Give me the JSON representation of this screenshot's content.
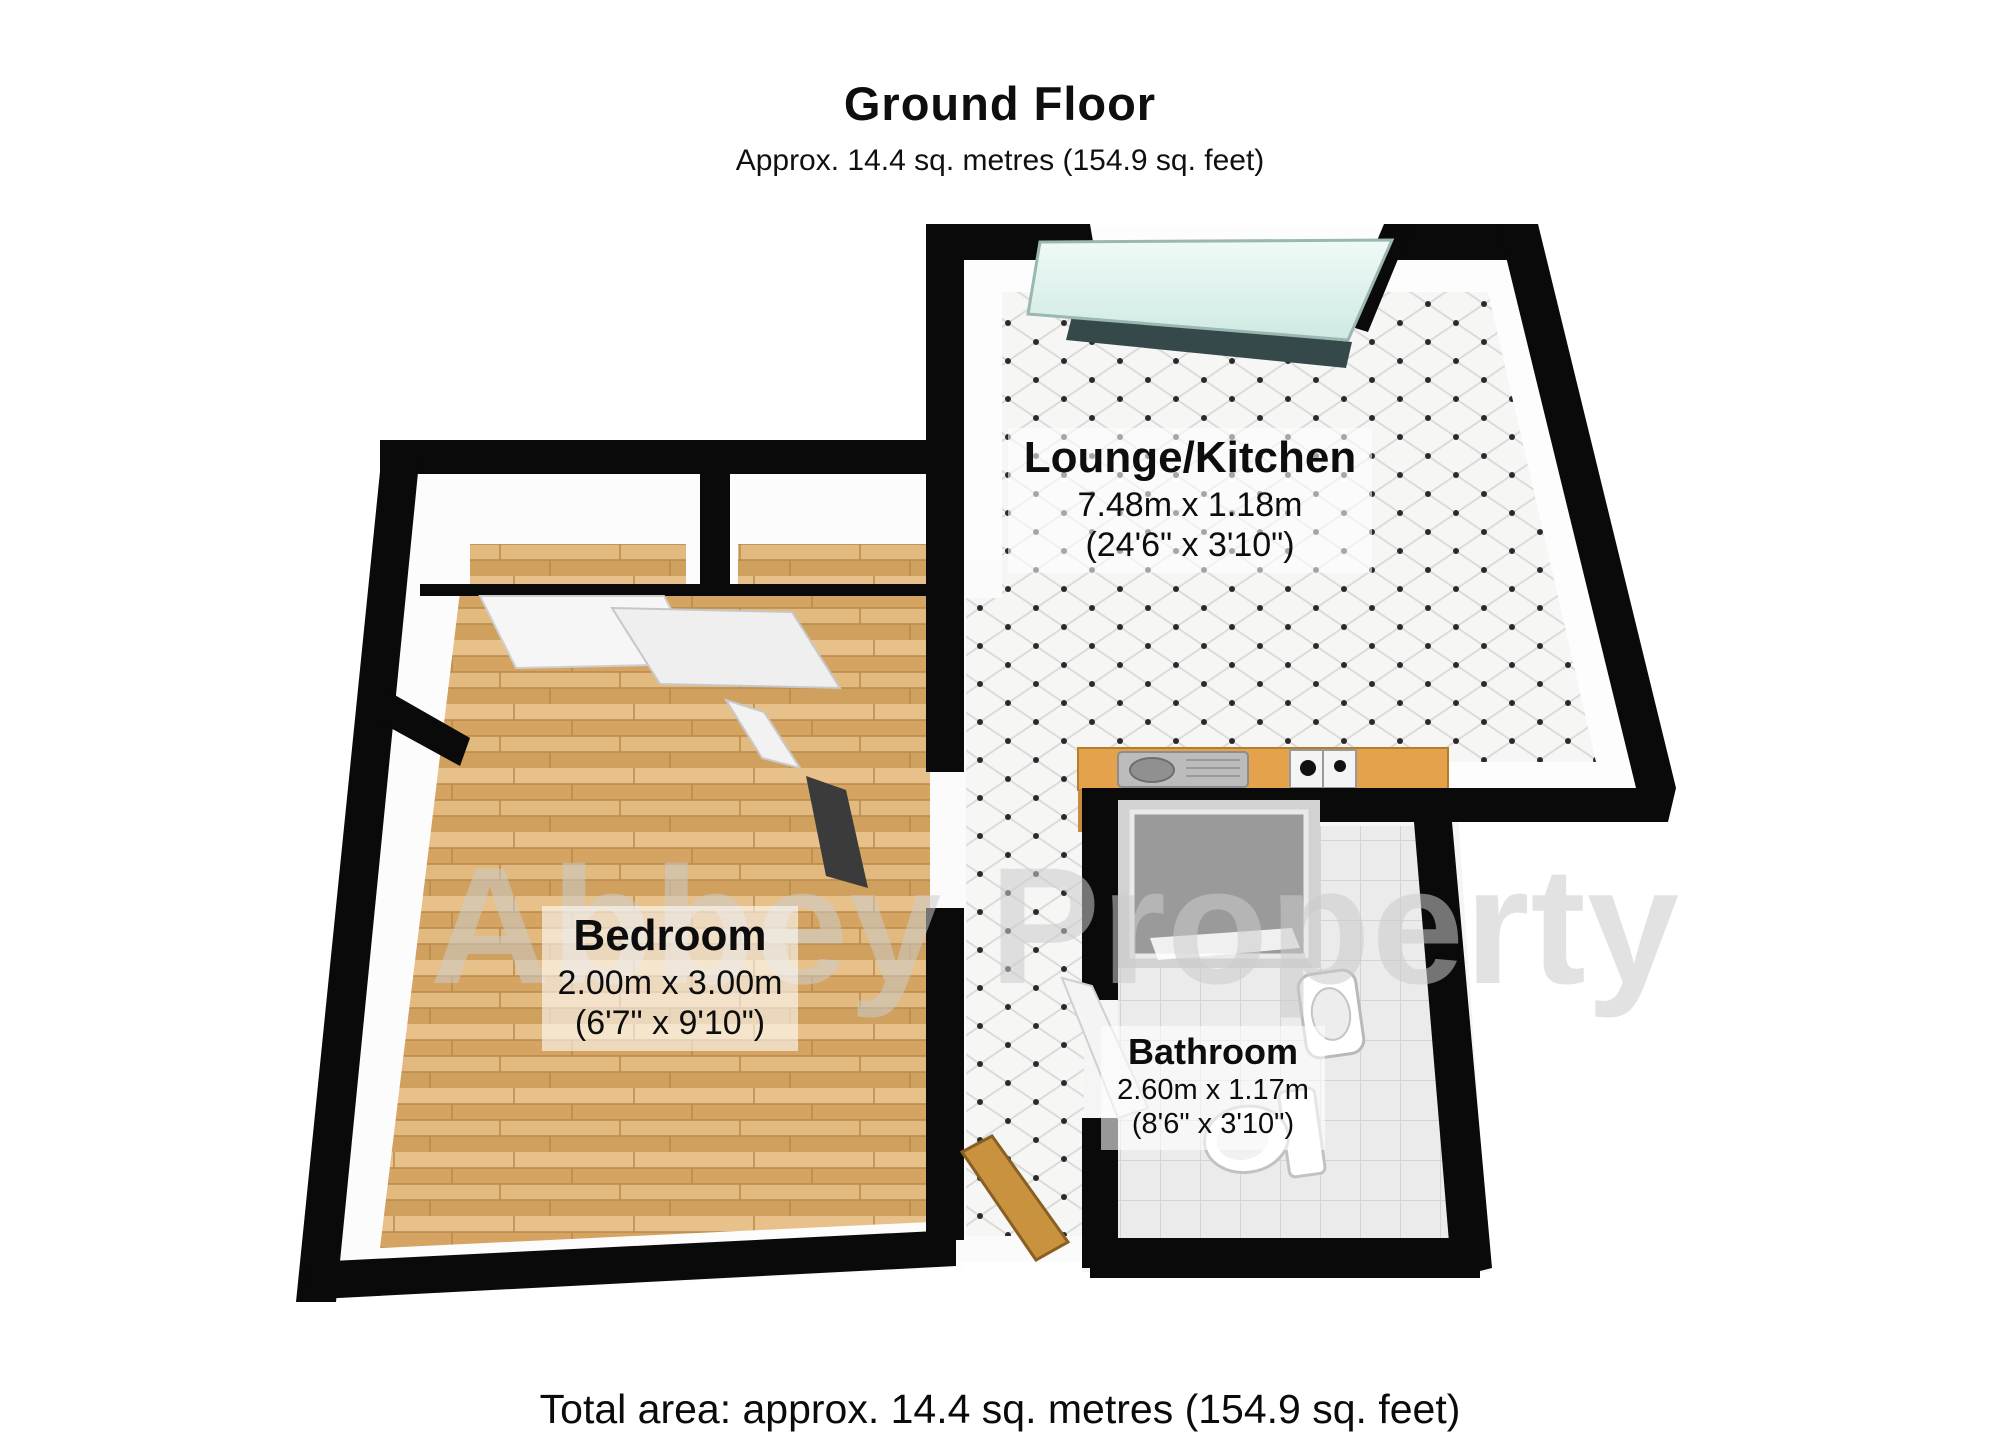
{
  "header": {
    "title": "Ground Floor",
    "subtitle": "Approx. 14.4 sq. metres (154.9 sq. feet)"
  },
  "rooms": [
    {
      "name": "Lounge/Kitchen",
      "size_metric": "7.48m x 1.18m",
      "size_imperial": "(24'6\" x 3'10\")"
    },
    {
      "name": "Bedroom",
      "size_metric": "2.00m x 3.00m",
      "size_imperial": "(6'7\" x 9'10\")"
    },
    {
      "name": "Bathroom",
      "size_metric": "2.60m x 1.17m",
      "size_imperial": "(8'6\" x 3'10\")"
    }
  ],
  "footer": {
    "total_area": "Total area: approx. 14.4 sq. metres (154.9 sq. feet)"
  },
  "watermark": {
    "text": "Abbey Property"
  },
  "fixtures": [
    "window",
    "kitchen-counter",
    "kitchen-sink",
    "gas-hob",
    "shower",
    "bathroom-sink",
    "toilet",
    "entrance-door",
    "bedroom-door",
    "bathroom-door",
    "wardrobe-sliding-doors"
  ],
  "colors": {
    "wall": "#0a0a0a",
    "wood_floor": "#ddb275",
    "tile_floor": "#f6f6f5",
    "tile_dot": "#2a2a2a",
    "bathroom_tile": "#ebebeb",
    "window_glass": "#e4f4f0",
    "kitchen_counter": "#e5a24d",
    "entrance_door_wood": "#c8923f",
    "watermark_grey": "#cccccc"
  }
}
